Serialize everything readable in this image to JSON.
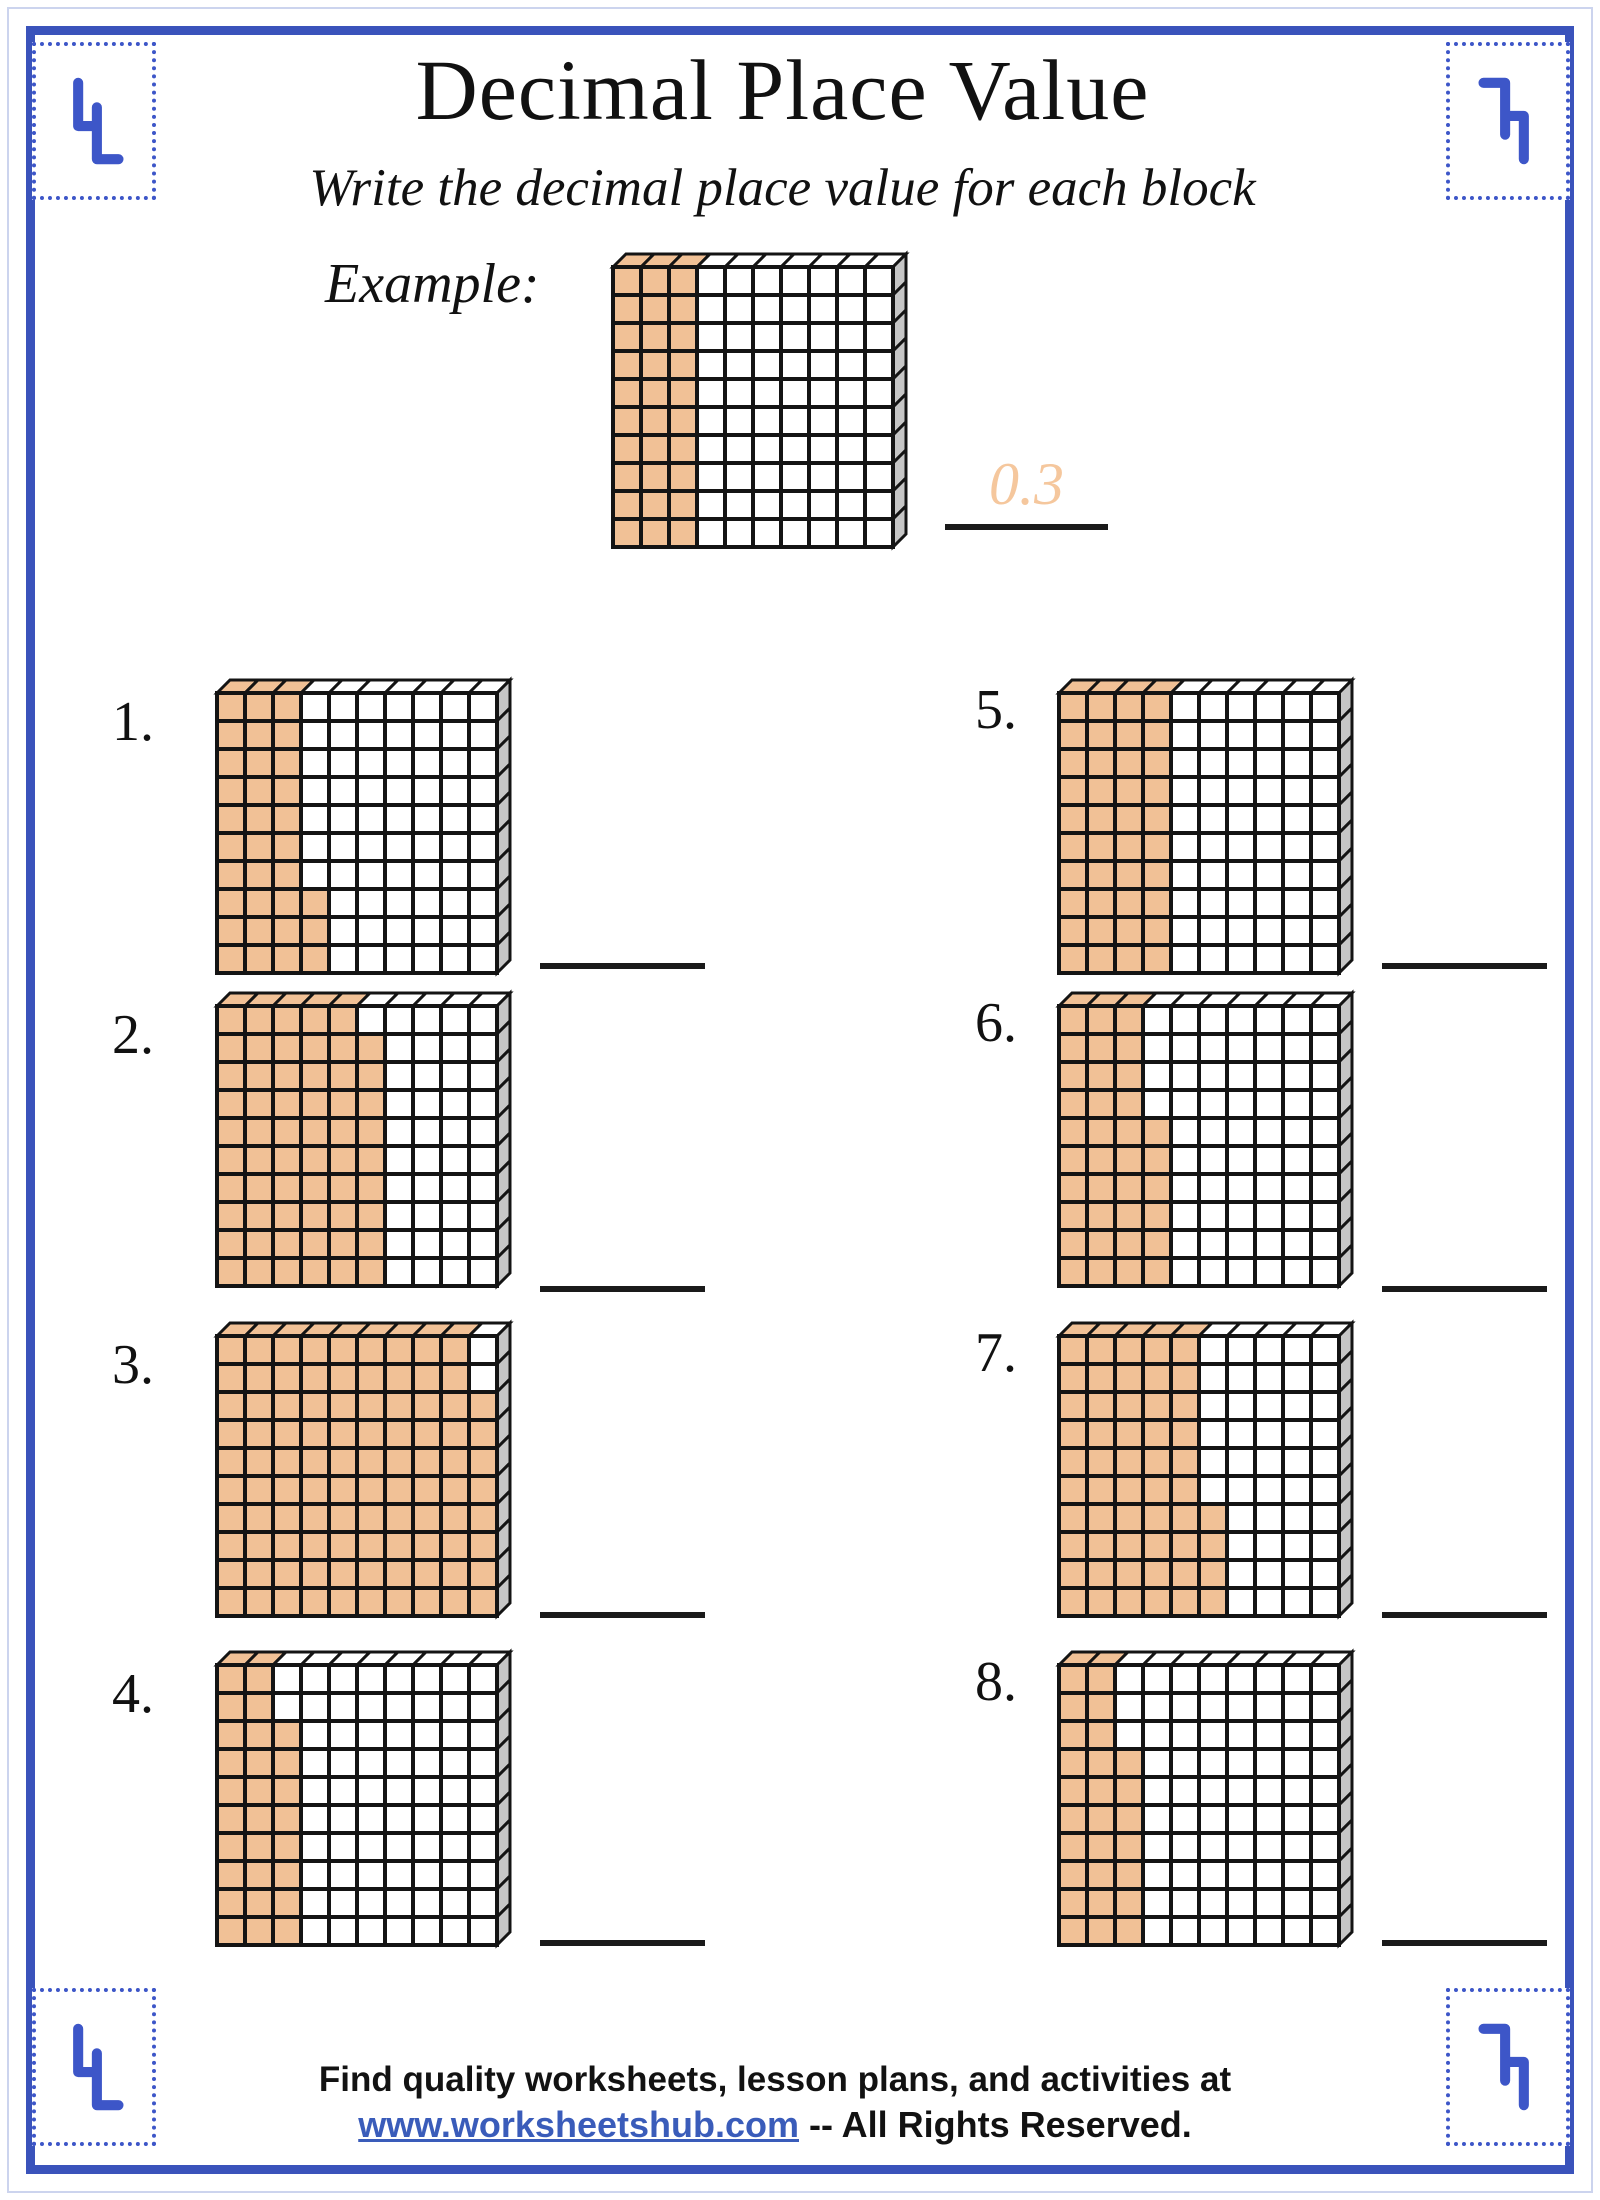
{
  "colors": {
    "frame_blue": "#3a53bb",
    "stamp_blue": "#3d56c8",
    "shade_orange": "#f1c196",
    "side_grey": "#c6c6c6",
    "block_line": "#141414",
    "answer_orange": "#f5c79d",
    "link_blue": "#3a5cba"
  },
  "header": {
    "title": "Decimal Place Value",
    "subtitle": "Write the decimal place value for each block"
  },
  "example": {
    "label": "Example:",
    "answer": "0.3",
    "columns": [
      10,
      10,
      10,
      0,
      0,
      0,
      0,
      0,
      0,
      0
    ]
  },
  "problems": [
    {
      "number": "1.",
      "columns": [
        10,
        10,
        10,
        3,
        0,
        0,
        0,
        0,
        0,
        0
      ]
    },
    {
      "number": "2.",
      "columns": [
        10,
        10,
        10,
        10,
        10,
        9,
        0,
        0,
        0,
        0
      ]
    },
    {
      "number": "3.",
      "columns": [
        10,
        10,
        10,
        10,
        10,
        10,
        10,
        10,
        10,
        8
      ]
    },
    {
      "number": "4.",
      "columns": [
        10,
        10,
        8,
        0,
        0,
        0,
        0,
        0,
        0,
        0
      ]
    },
    {
      "number": "5.",
      "columns": [
        10,
        10,
        10,
        10,
        0,
        0,
        0,
        0,
        0,
        0
      ]
    },
    {
      "number": "6.",
      "columns": [
        10,
        10,
        10,
        6,
        0,
        0,
        0,
        0,
        0,
        0
      ]
    },
    {
      "number": "7.",
      "columns": [
        10,
        10,
        10,
        10,
        10,
        4,
        0,
        0,
        0,
        0
      ]
    },
    {
      "number": "8.",
      "columns": [
        10,
        10,
        7,
        0,
        0,
        0,
        0,
        0,
        0,
        0
      ]
    }
  ],
  "footer": {
    "line1": "Find quality worksheets, lesson plans, and activities at",
    "link": "www.worksheetshub.com",
    "line2_rest": " -- All Rights Reserved."
  }
}
